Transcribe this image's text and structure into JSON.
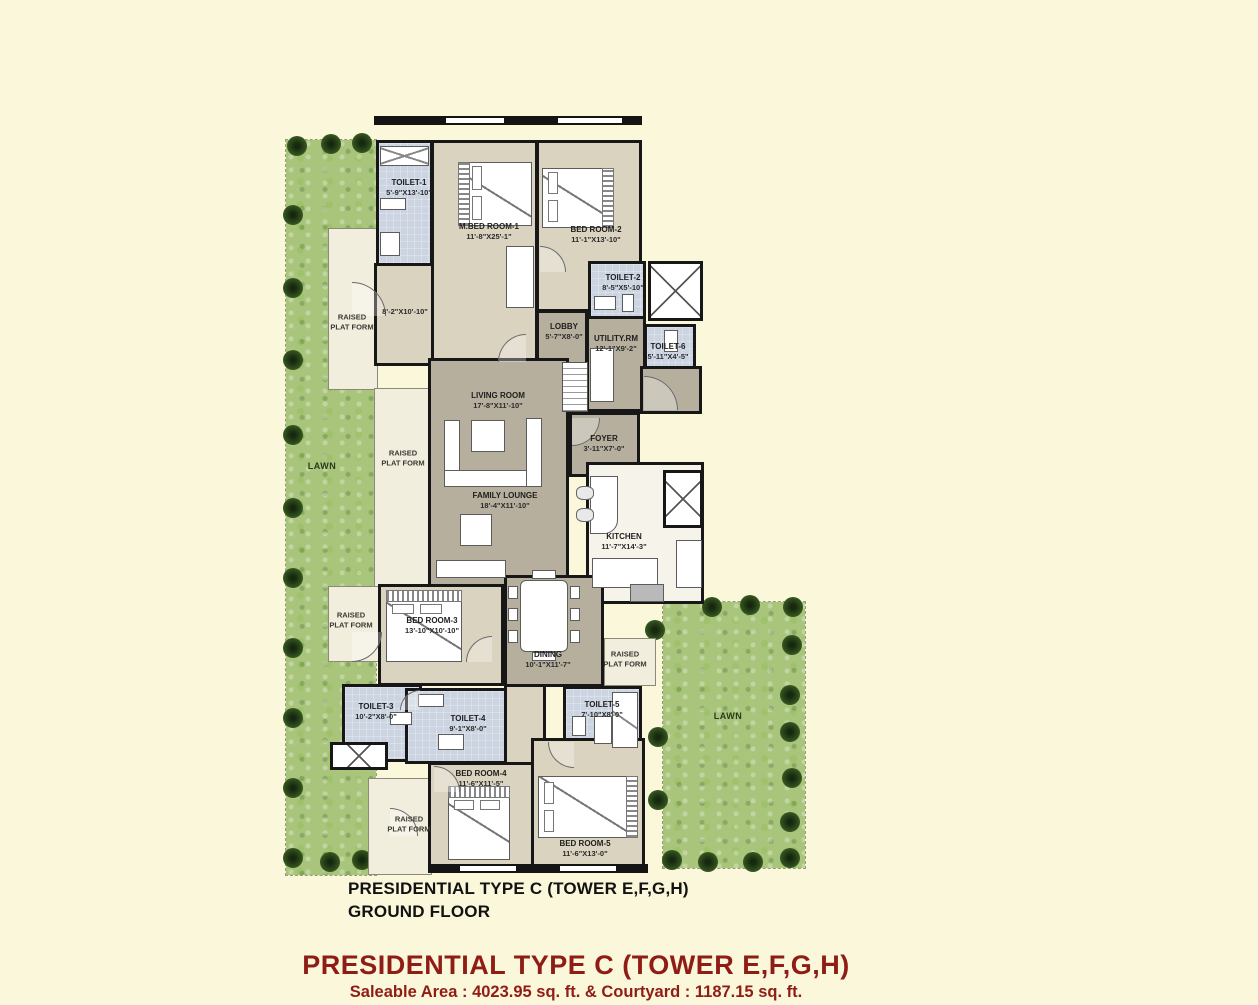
{
  "lawns": {
    "left": "LAWN",
    "right": "LAWN"
  },
  "platform_label": "RAISED\nPLAT FORM",
  "rooms": {
    "toilet1": {
      "name": "TOILET-1",
      "dim": "5'-9\"X13'-10\""
    },
    "mbed1": {
      "name": "M.BED ROOM-1",
      "dim": "11'-8\"X25'-1\""
    },
    "bed2": {
      "name": "BED ROOM-2",
      "dim": "11'-1\"X13'-10\""
    },
    "toilet2": {
      "name": "TOILET-2",
      "dim": "8'-5\"X5'-10\""
    },
    "lobby": {
      "name": "LOBBY",
      "dim": "5'-7\"X8'-0\""
    },
    "utility": {
      "name": "UTILITY.RM",
      "dim": "12'-1\"X9'-2\""
    },
    "toilet6": {
      "name": "TOILET-6",
      "dim": "5'-11\"X4'-5\""
    },
    "passage": {
      "dim": "8'-2\"X10'-10\""
    },
    "living": {
      "name": "LIVING ROOM",
      "dim": "17'-8\"X11'-10\""
    },
    "foyer": {
      "name": "FOYER",
      "dim": "3'-11\"X7'-0\""
    },
    "family": {
      "name": "FAMILY LOUNGE",
      "dim": "18'-4\"X11'-10\""
    },
    "kitchen": {
      "name": "KITCHEN",
      "dim": "11'-7\"X14'-3\""
    },
    "dining": {
      "name": "DINING",
      "dim": "10'-1\"X11'-7\""
    },
    "bed3": {
      "name": "BED ROOM-3",
      "dim": "13'-10\"X10'-10\""
    },
    "toilet3": {
      "name": "TOILET-3",
      "dim": "10'-2\"X8'-0\""
    },
    "toilet4": {
      "name": "TOILET-4",
      "dim": "9'-1\"X8'-0\""
    },
    "toilet5": {
      "name": "TOILET-5",
      "dim": "7'-10\"X8'-0\""
    },
    "bed4": {
      "name": "BED ROOM-4",
      "dim": "11'-6\"X11'-5\""
    },
    "bed5": {
      "name": "BED ROOM-5",
      "dim": "11'-6\"X13'-0\""
    }
  },
  "caption": {
    "line1": "PRESIDENTIAL TYPE C (TOWER E,F,G,H)",
    "line2": "GROUND FLOOR"
  },
  "footer": {
    "title": "PRESIDENTIAL TYPE C (TOWER E,F,G,H)",
    "subtitle": "Saleable Area : 4023.95 sq. ft. & Courtyard : 1187.15 sq. ft."
  },
  "colors": {
    "background": "#FBF7DB",
    "lawn": "#A9C57C",
    "wall": "#141414",
    "bedroom_floor": "#DAD3BF",
    "living_floor": "#B6AF9E",
    "toilet_floor": "#CBD4E0",
    "platform": "#F2EEDE",
    "footer_red": "#8F1D15"
  }
}
